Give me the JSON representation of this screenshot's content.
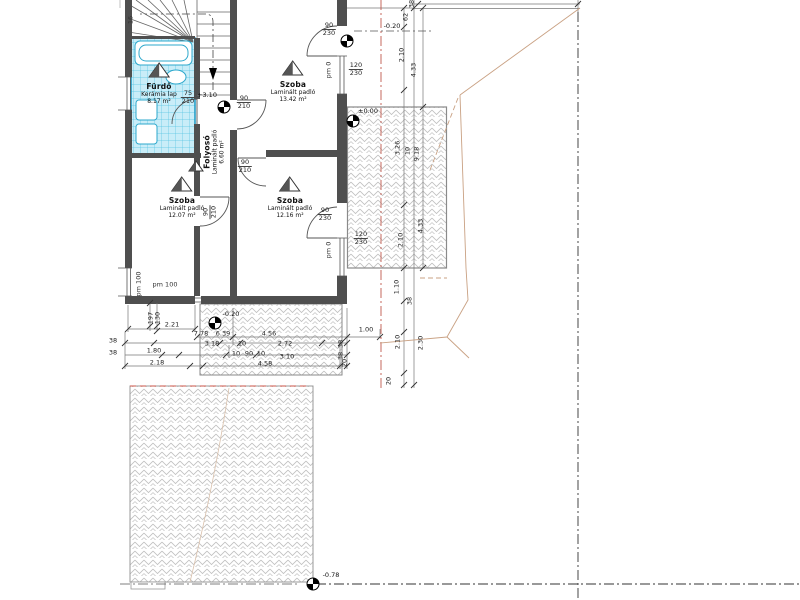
{
  "plan": {
    "rooms": [
      {
        "name": "Fürdő",
        "floor": "Kerámia lap",
        "area": "8.17 m²"
      },
      {
        "name": "Folyosó",
        "floor": "Laminált padló",
        "area": "6.60 m²"
      },
      {
        "name": "Szoba",
        "floor": "Laminált padló",
        "area": "13.42 m²"
      },
      {
        "name": "Szoba",
        "floor": "Laminált padló",
        "area": "12.07 m²"
      },
      {
        "name": "Szoba",
        "floor": "Laminált padló",
        "area": "12.16 m²"
      }
    ],
    "levels": [
      {
        "value": "+3.10"
      },
      {
        "value": "-0.20"
      },
      {
        "value": "±0.00"
      },
      {
        "value": "-0.20"
      },
      {
        "value": "-0.78"
      }
    ],
    "openings": [
      {
        "w": "90",
        "h": "230",
        "x": 329,
        "y": 22,
        "rot": 0
      },
      {
        "w": "120",
        "h": "230",
        "x": 356,
        "y": 62,
        "rot": 0
      },
      {
        "w": "75",
        "h": "210",
        "x": 188,
        "y": 90,
        "rot": 0
      },
      {
        "w": "90",
        "h": "210",
        "x": 244,
        "y": 95,
        "rot": 0
      },
      {
        "w": "90",
        "h": "210",
        "x": 210,
        "y": 212,
        "rot": 1
      },
      {
        "w": "90",
        "h": "210",
        "x": 245,
        "y": 159,
        "rot": 0
      },
      {
        "w": "90",
        "h": "230",
        "x": 325,
        "y": 207,
        "rot": 0
      },
      {
        "w": "120",
        "h": "230",
        "x": 361,
        "y": 231,
        "rot": 0
      }
    ],
    "annotations": [
      {
        "t": "pm 0",
        "x": 329,
        "y": 70,
        "rot": 1
      },
      {
        "t": "pm 0",
        "x": 329,
        "y": 250,
        "rot": 1
      },
      {
        "t": "pm 100",
        "x": 139,
        "y": 284,
        "rot": 1
      },
      {
        "t": "pm 100",
        "x": 165,
        "y": 285,
        "rot": 0
      },
      {
        "t": "16",
        "x": 131,
        "y": 20,
        "rot": 1
      }
    ],
    "dimensions": [
      {
        "t": "2.21",
        "x": 172,
        "y": 325,
        "rot": 0
      },
      {
        "t": "7.78",
        "x": 201,
        "y": 334,
        "rot": 0
      },
      {
        "t": "6.39",
        "x": 223,
        "y": 334,
        "rot": 0
      },
      {
        "t": "4.56",
        "x": 269,
        "y": 334,
        "rot": 0
      },
      {
        "t": "1.00",
        "x": 366,
        "y": 330,
        "rot": 0
      },
      {
        "t": "3.18",
        "x": 212,
        "y": 344,
        "rot": 0
      },
      {
        "t": "10",
        "x": 242,
        "y": 344,
        "rot": 0
      },
      {
        "t": "2.72",
        "x": 285,
        "y": 344,
        "rot": 0
      },
      {
        "t": "38",
        "x": 341,
        "y": 344,
        "rot": 1
      },
      {
        "t": "1.80",
        "x": 154,
        "y": 351,
        "rot": 0
      },
      {
        "t": "10",
        "x": 236,
        "y": 354,
        "rot": 0
      },
      {
        "t": "90",
        "x": 249,
        "y": 354,
        "rot": 0
      },
      {
        "t": "10",
        "x": 261,
        "y": 354,
        "rot": 0
      },
      {
        "t": "3.10",
        "x": 287,
        "y": 357,
        "rot": 0
      },
      {
        "t": "38",
        "x": 341,
        "y": 356,
        "rot": 1
      },
      {
        "t": "2.18",
        "x": 157,
        "y": 363,
        "rot": 0
      },
      {
        "t": "4.58",
        "x": 265,
        "y": 364,
        "rot": 0
      },
      {
        "t": "20",
        "x": 345,
        "y": 363,
        "rot": 1
      },
      {
        "t": "197",
        "x": 151,
        "y": 318,
        "rot": 1
      },
      {
        "t": "130",
        "x": 158,
        "y": 318,
        "rot": 1
      },
      {
        "t": "38",
        "x": 113,
        "y": 341,
        "rot": 0
      },
      {
        "t": "38",
        "x": 113,
        "y": 353,
        "rot": 0
      },
      {
        "t": "38",
        "x": 412,
        "y": 4,
        "rot": 1
      },
      {
        "t": "62",
        "x": 406,
        "y": 17,
        "rot": 1
      },
      {
        "t": "2.10",
        "x": 402,
        "y": 55,
        "rot": 1
      },
      {
        "t": "4.33",
        "x": 414,
        "y": 70,
        "rot": 1
      },
      {
        "t": "3.26",
        "x": 398,
        "y": 148,
        "rot": 1
      },
      {
        "t": "10",
        "x": 408,
        "y": 151,
        "rot": 1
      },
      {
        "t": "9.18",
        "x": 417,
        "y": 154,
        "rot": 1
      },
      {
        "t": "4.33",
        "x": 421,
        "y": 226,
        "rot": 1
      },
      {
        "t": "2.10",
        "x": 401,
        "y": 240,
        "rot": 1
      },
      {
        "t": "1.10",
        "x": 397,
        "y": 287,
        "rot": 1
      },
      {
        "t": "38",
        "x": 410,
        "y": 301,
        "rot": 1
      },
      {
        "t": "2.10",
        "x": 398,
        "y": 342,
        "rot": 1
      },
      {
        "t": "2.30",
        "x": 421,
        "y": 343,
        "rot": 1
      },
      {
        "t": "20",
        "x": 389,
        "y": 381,
        "rot": 1
      }
    ]
  }
}
